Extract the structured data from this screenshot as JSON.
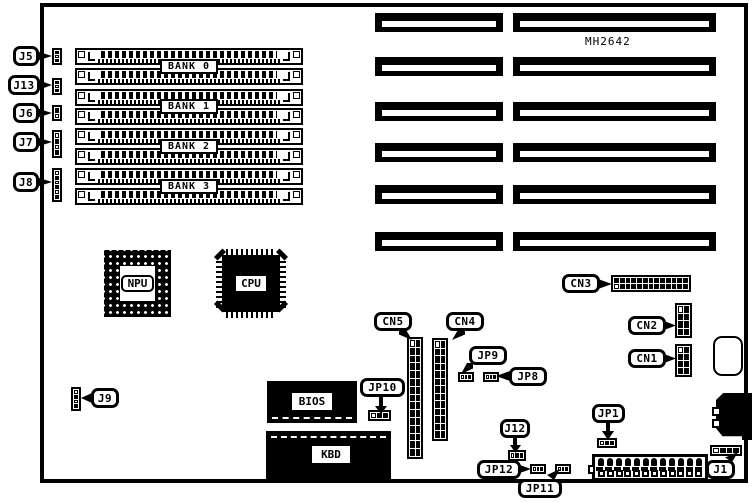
{
  "board": {
    "model": "MH2642",
    "memory_banks": [
      "BANK 0",
      "BANK 1",
      "BANK 2",
      "BANK 3"
    ],
    "chips": {
      "npu": "NPU",
      "cpu": "CPU",
      "bios": "BIOS",
      "kbd": "KBD"
    },
    "connectors": {
      "cn1": "CN1",
      "cn2": "CN2",
      "cn3": "CN3",
      "cn4": "CN4",
      "cn5": "CN5",
      "j1": "J1"
    },
    "jumpers": {
      "j5": "J5",
      "j13": "J13",
      "j6": "J6",
      "j7": "J7",
      "j8": "J8",
      "j9": "J9",
      "j12": "J12",
      "jp1": "JP1",
      "jp8": "JP8",
      "jp9": "JP9",
      "jp10": "JP10",
      "jp11": "JP11",
      "jp12": "JP12"
    },
    "colors": {
      "line": "#000000",
      "background": "#ffffff"
    }
  }
}
